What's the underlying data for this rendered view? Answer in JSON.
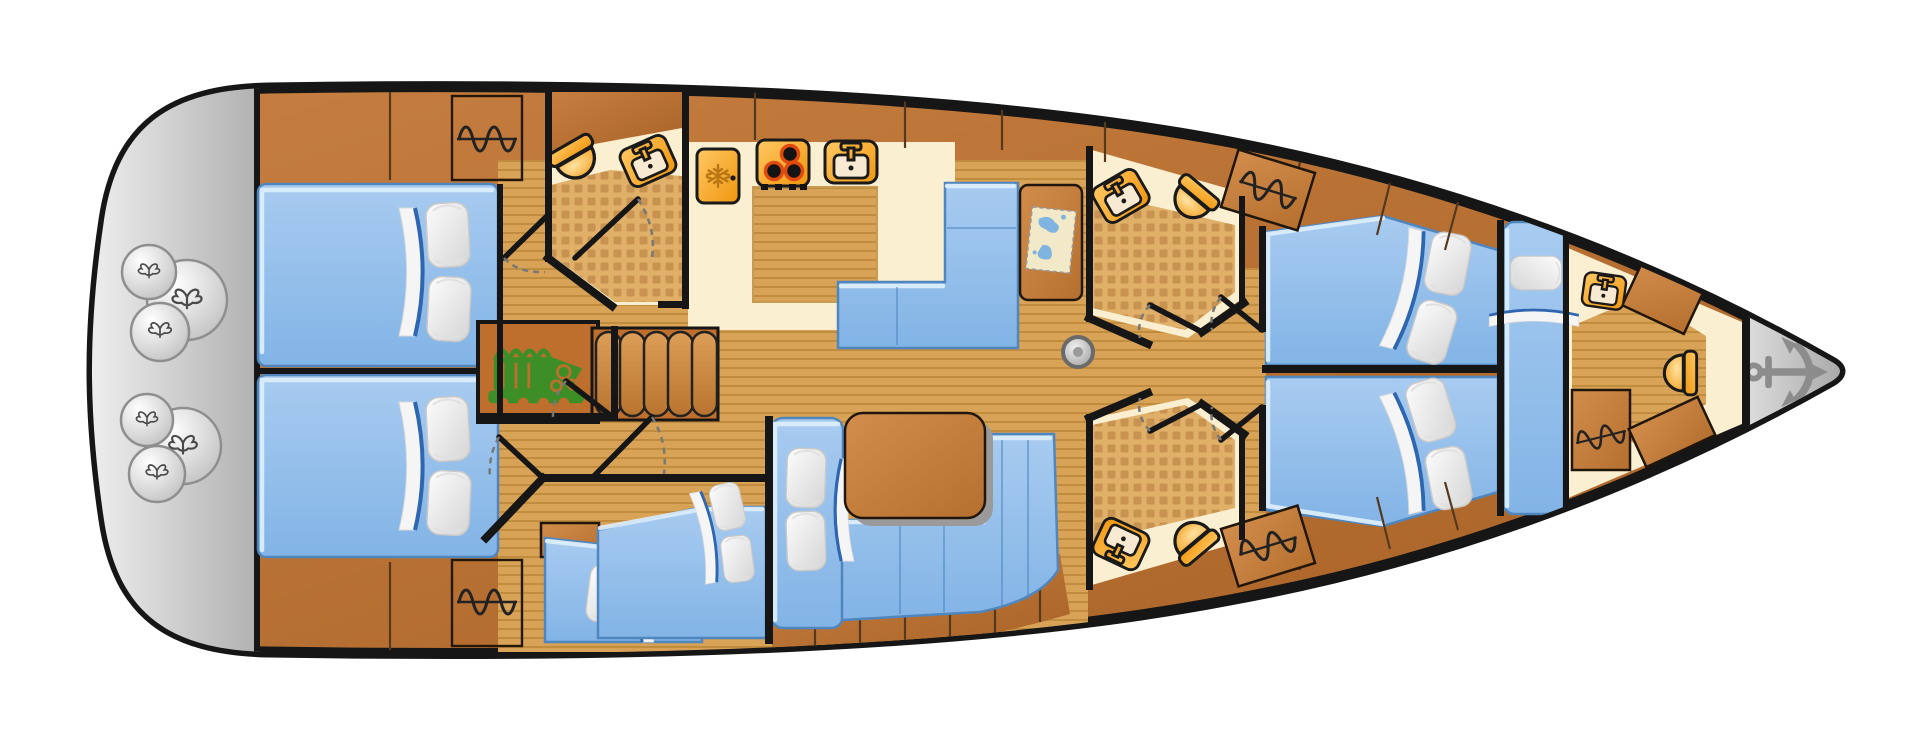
{
  "diagram": {
    "kind": "sailing-yacht interior floor plan (top view, bow right / stern left)",
    "visible_text": [],
    "colors": {
      "background": "#FFFFFF",
      "hull-outline": "#161616",
      "hull-wood-light": "#C67F40",
      "hull-wood-dark": "#A96226",
      "furniture-wood-light": "#D28C4B",
      "furniture-wood-dark": "#B56F2F",
      "floor-light": "#D8A257",
      "floor-line": "#C08C3E",
      "tile-base": "#E0B069",
      "tile-square": "#C89350",
      "counter-cream": "#FAEFD0",
      "upholstery-light": "#A8CBF0",
      "upholstery-dark": "#82B4E6",
      "upholstery-edge": "#4F86BE",
      "upholstery-highlight": "#DFF0FC",
      "blanket-fold-blue": "#2E66B0",
      "pillow-light": "#FCFCFC",
      "pillow-dark": "#D5D5D5",
      "fixture-orange-light": "#FFC863",
      "fixture-orange-dark": "#F0960E",
      "fixture-outline": "#1A1A1A",
      "basin-cream": "#F7E9D2",
      "burner-ring": "#E0490F",
      "snowflake": "#B87714",
      "engine-green": "#3E8E28",
      "platform-gray-light": "#EFEFEF",
      "platform-gray-dark": "#B0B0B0",
      "anchor-gray": "#8C8C8C",
      "map-paper": "#F2E9C8",
      "map-water": "#7FB3E0",
      "door-arc": "#777777",
      "symbol-black": "#222222"
    },
    "icons": [
      "anchor-icon",
      "engine-icon",
      "fridge-icon",
      "stove-icon",
      "sink-icon",
      "toilet-icon",
      "hanging-locker-icon",
      "fender-rope-icon",
      "chart-map-icon",
      "mast-icon",
      "stairs-icon"
    ],
    "rooms": [
      {
        "id": "stern-platform",
        "fixtures": [
          "fender-cluster-of-3",
          "fender-cluster-of-3"
        ]
      },
      {
        "id": "aft-cabin-port",
        "fixtures": [
          "double-berth",
          "2 pillows",
          "hanging-locker"
        ]
      },
      {
        "id": "aft-cabin-starboard",
        "fixtures": [
          "double-berth",
          "2 pillows",
          "hanging-locker"
        ]
      },
      {
        "id": "aft-head",
        "fixtures": [
          "toilet",
          "washbasin",
          "tiled-floor",
          "door"
        ]
      },
      {
        "id": "galley",
        "fixtures": [
          "fridge",
          "3-burner-stove",
          "sink",
          "counter"
        ]
      },
      {
        "id": "salon",
        "fixtures": [
          "l-settee",
          "chart-table-with-map",
          "dining-table",
          "u-sofa",
          "2 pillows",
          "mast-post"
        ]
      },
      {
        "id": "midship-cabin",
        "fixtures": [
          "single-berth",
          "single-berth",
          "nightstand",
          "3 pillows"
        ]
      },
      {
        "id": "engine-compartment",
        "fixtures": [
          "engine"
        ]
      },
      {
        "id": "companionway",
        "fixtures": [
          "5-step-stairs"
        ]
      },
      {
        "id": "forward-head-port",
        "fixtures": [
          "toilet",
          "washbasin",
          "tiled-floor",
          "door"
        ]
      },
      {
        "id": "forward-head-starboard",
        "fixtures": [
          "toilet",
          "washbasin",
          "tiled-floor",
          "door"
        ]
      },
      {
        "id": "forward-cabin-port",
        "fixtures": [
          "double-berth",
          "2 pillows",
          "hanging-locker",
          "door"
        ]
      },
      {
        "id": "forward-cabin-starboard",
        "fixtures": [
          "double-berth",
          "2 pillows",
          "hanging-locker",
          "door"
        ]
      },
      {
        "id": "forepeak-cabin",
        "fixtures": [
          "single-berth",
          "pillow"
        ]
      },
      {
        "id": "bow-head",
        "fixtures": [
          "toilet",
          "washbasin",
          "hanging-locker",
          "cabinets"
        ]
      },
      {
        "id": "anchor-locker",
        "fixtures": [
          "anchor"
        ]
      }
    ]
  }
}
